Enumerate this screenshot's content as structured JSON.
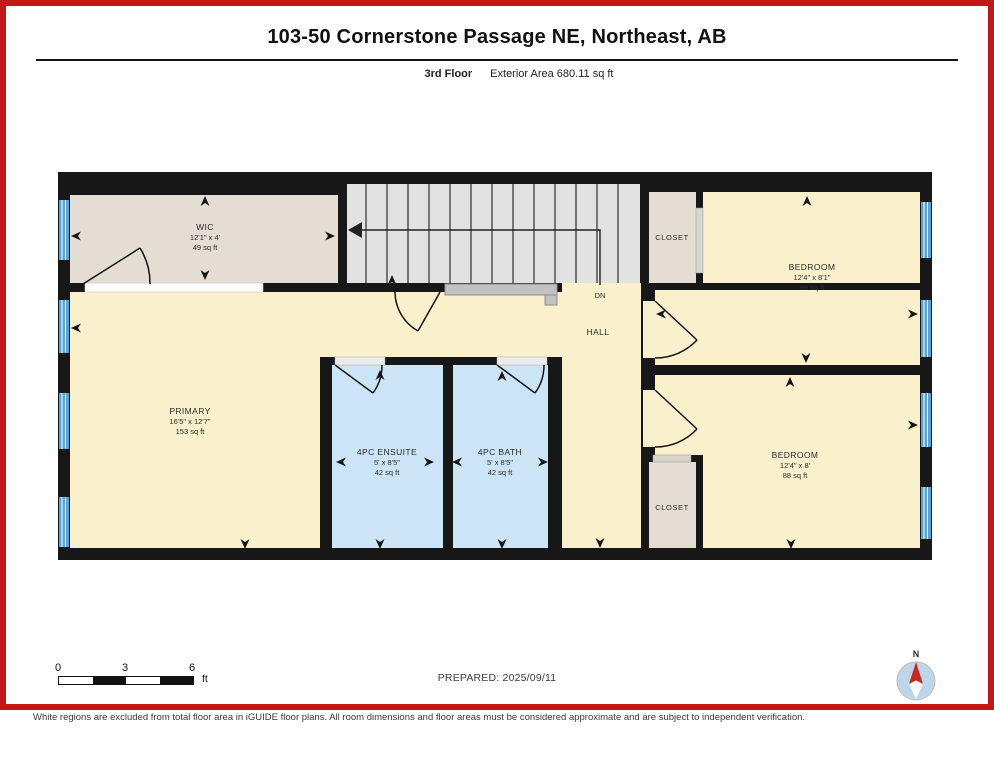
{
  "header": {
    "title": "103-50 Cornerstone Passage NE, Northeast, AB",
    "floor_label": "3rd Floor",
    "area_label": "Exterior Area 680.11 sq ft"
  },
  "rooms": {
    "wic": {
      "name": "WIC",
      "dims": "12'1\" x 4'",
      "area": "49 sq ft"
    },
    "closet_top": {
      "name": "CLOSET"
    },
    "bedroom_top": {
      "name": "BEDROOM",
      "dims": "12'4\" x 8'1\"",
      "area": "89 sq ft"
    },
    "hall": {
      "name": "HALL"
    },
    "stairs_label": "DN",
    "primary": {
      "name": "PRIMARY",
      "dims": "16'5\" x 12'7\"",
      "area": "153 sq ft"
    },
    "ensuite": {
      "name": "4PC ENSUITE",
      "dims": "5' x 8'5\"",
      "area": "42 sq ft"
    },
    "bath": {
      "name": "4PC BATH",
      "dims": "5' x 8'5\"",
      "area": "42 sq ft"
    },
    "closet_bottom": {
      "name": "CLOSET"
    },
    "bedroom_bottom": {
      "name": "BEDROOM",
      "dims": "12'4\" x 8'",
      "area": "88 sq ft"
    }
  },
  "scale_bar": {
    "labels": [
      "0",
      "3",
      "6"
    ],
    "unit": "ft"
  },
  "compass": {
    "north_label": "N"
  },
  "footer": {
    "prepared": "PREPARED: 2025/09/11",
    "disclaimer": "White regions are excluded from total floor area in iGUIDE floor plans. All room dimensions and floor areas must be considered approximate and are subject to independent verification."
  },
  "colors": {
    "frame_red": "#c2181b",
    "room_yellow": "#faf0cb",
    "room_blue": "#cce5f6",
    "room_beige": "#e4ddd3",
    "stairs_gray": "#e2e2e3",
    "window_blue": "#57a4d9",
    "wall_black": "#171717",
    "compass_needle_red": "#c4281f"
  }
}
